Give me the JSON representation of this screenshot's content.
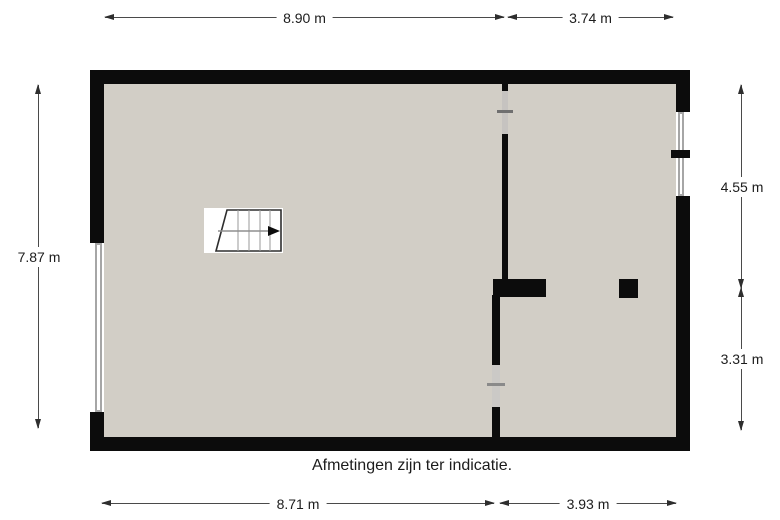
{
  "caption": "Afmetingen zijn ter indicatie.",
  "dimensions": {
    "top_left": {
      "label": "8.90 m",
      "side": "top"
    },
    "top_right": {
      "label": "3.74 m",
      "side": "top"
    },
    "left": {
      "label": "7.87 m",
      "side": "left"
    },
    "right_upper": {
      "label": "4.55 m",
      "side": "right"
    },
    "right_lower": {
      "label": "3.31 m",
      "side": "right"
    },
    "bottom_left": {
      "label": "8.71 m",
      "side": "bottom"
    },
    "bottom_right": {
      "label": "3.93 m",
      "side": "bottom"
    }
  },
  "plan": {
    "rooms": 2,
    "features": [
      "stairs",
      "interior-wall-with-doors",
      "left-window",
      "right-double-window",
      "column"
    ],
    "stairs_direction": "right"
  },
  "colors": {
    "wall": "#0c0c0c",
    "floor": "#d2cec6",
    "window-frame": "#a6a6a6",
    "door-upper": "#c6c3c0",
    "door-lower": "#cbc9c6",
    "door-tick": "#6f6f6f",
    "dim-line": "#4a4a4a",
    "dim-arrow": "#2e2e2e",
    "dim-text": "#1c1c1c",
    "stairs-line": "#9a9a9a",
    "stairs-border": "#2e2e2e"
  }
}
